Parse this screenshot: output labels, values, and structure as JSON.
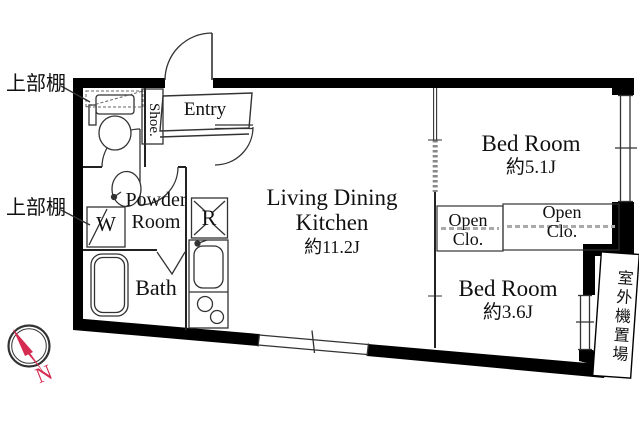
{
  "floor_plan": {
    "annotations": {
      "upper_shelf_top": "上部棚",
      "upper_shelf_bottom": "上部棚",
      "outdoor_unit_space": "室外機置場"
    },
    "rooms": {
      "entry": {
        "label": "Entry"
      },
      "shoe_cabinet": {
        "label": "Shoe."
      },
      "powder_room": {
        "label": "Powder Room"
      },
      "washing_machine": {
        "label": "W"
      },
      "refrigerator": {
        "label": "R"
      },
      "bath": {
        "label": "Bath"
      },
      "ldk": {
        "label": "Living Dining Kitchen",
        "size": "約11.2J"
      },
      "bedroom_top": {
        "label": "Bed Room",
        "size": "約5.1J"
      },
      "bedroom_bottom": {
        "label": "Bed Room",
        "size": "約3.6J"
      },
      "open_closet_left": {
        "label": "Open Clo."
      },
      "open_closet_right": {
        "label": "Open Clo."
      }
    },
    "compass": {
      "north": "N"
    },
    "colors": {
      "wall": "#000000",
      "thin_line": "#333333",
      "compass_red": "#d52b50",
      "background": "#ffffff"
    }
  }
}
